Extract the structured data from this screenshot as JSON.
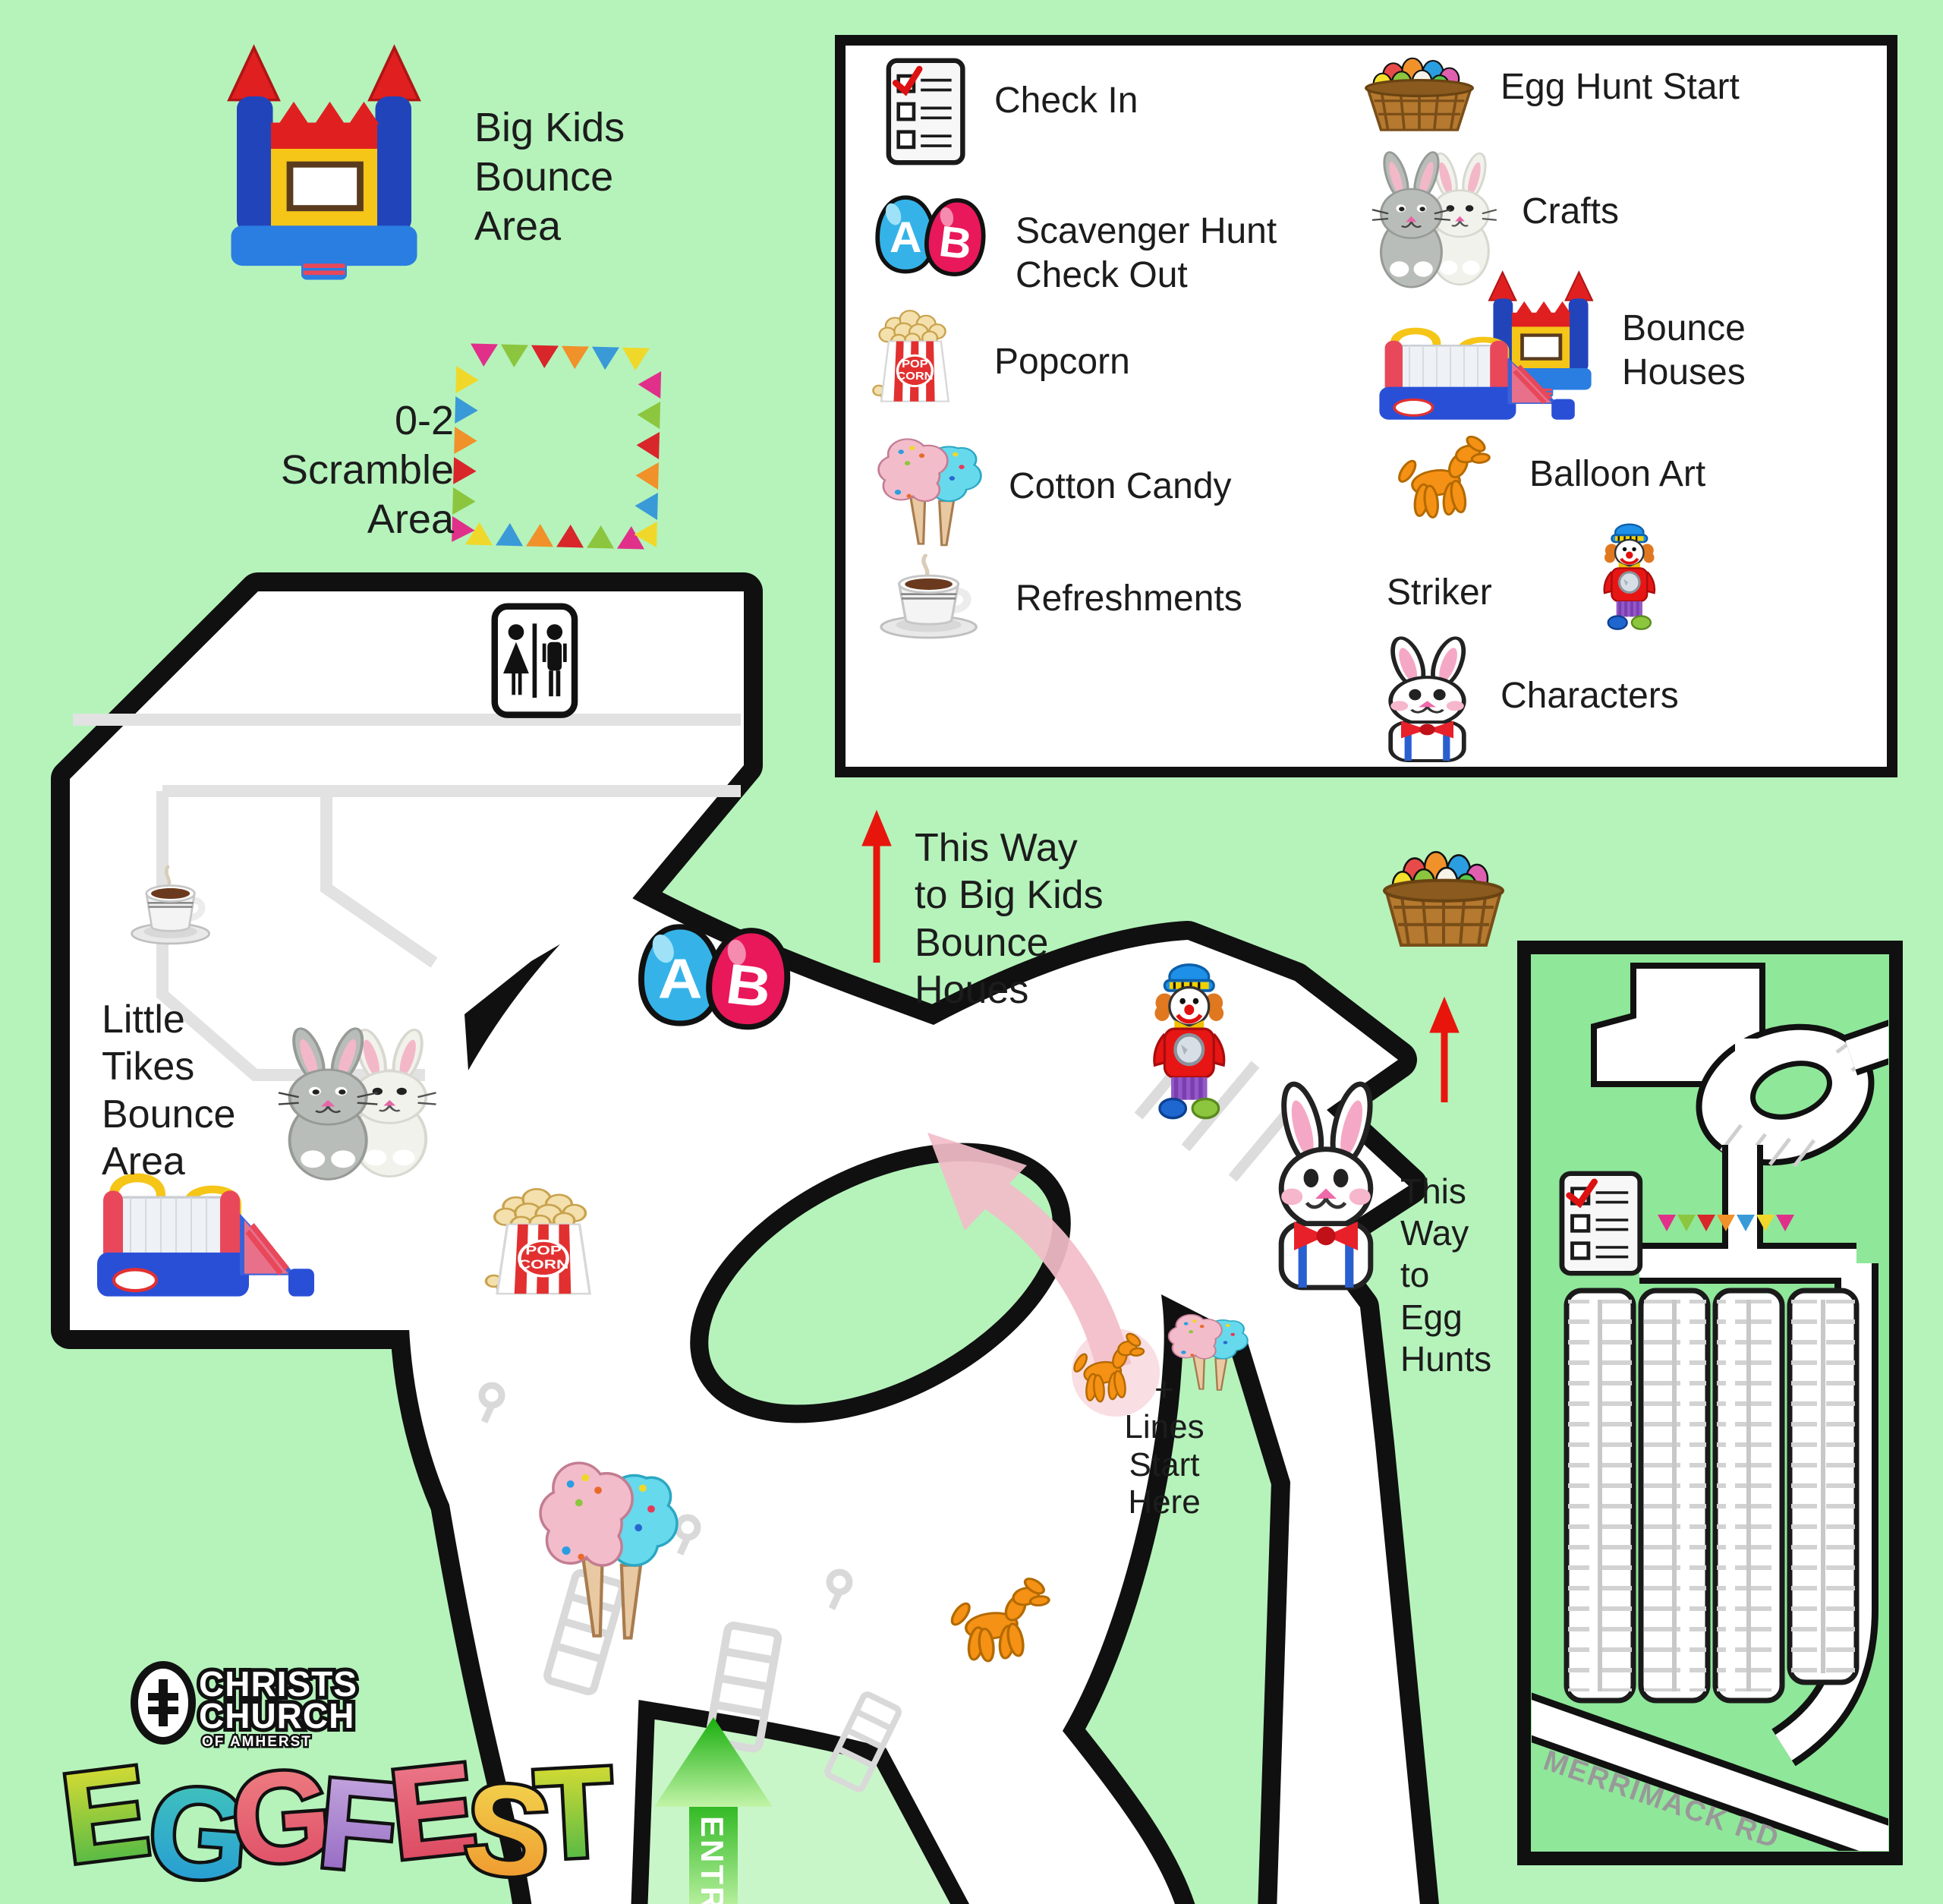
{
  "colors": {
    "bg": "#b5f3bb",
    "inset_bg": "#8fe79a",
    "entry_bg": "#c9f6c9",
    "outline": "#101010",
    "gray_line": "#e2e2e2",
    "red": "#e8150d",
    "pink": "#f2bdc9",
    "text": "#1c1c1c"
  },
  "legend": {
    "left": [
      {
        "icon": "checklist-icon",
        "label": "Check In"
      },
      {
        "icon": "ab-eggs-icon",
        "label": "Scavenger Hunt\nCheck Out"
      },
      {
        "icon": "popcorn-icon",
        "label": "Popcorn"
      },
      {
        "icon": "cotton-candy-icon",
        "label": "Cotton Candy"
      },
      {
        "icon": "coffee-icon",
        "label": "Refreshments"
      }
    ],
    "right": [
      {
        "icon": "egg-basket-icon",
        "label": "Egg Hunt Start"
      },
      {
        "icon": "bunny-crafts-icon",
        "label": "Crafts"
      },
      {
        "icon": "bounce-houses-icon",
        "label": "Bounce\nHouses"
      },
      {
        "icon": "balloon-dog-icon",
        "label": "Balloon Art"
      },
      {
        "icon": "clown-icon",
        "label": "Striker"
      },
      {
        "icon": "bunny-character-icon",
        "label": "Characters"
      }
    ]
  },
  "map_labels": {
    "big_kids": "Big Kids\nBounce\nArea",
    "scramble": "0-2\nScramble\nArea",
    "little_tikes": "Little\nTikes\nBounce\nArea",
    "this_way_bounce": "This Way\nto Big Kids\nBounce\nHoues",
    "this_way_egg": "This\nWay\nto\nEgg\nHunts",
    "lines_start": "+\nLines\nStart\nHere",
    "entry": "ENTRY",
    "road": "MERRIMACK RD"
  },
  "icons": {
    "egg_a": "A",
    "egg_b": "B",
    "popcorn_top": "POP",
    "popcorn_bottom": "CORN"
  },
  "logo": {
    "church_line1": "CHRISTS",
    "church_line2": "CHURCH",
    "church_line3": "OF AMHERST",
    "title_letters": [
      {
        "ch": "E"
      },
      {
        "ch": "G"
      },
      {
        "ch": "G"
      },
      {
        "ch": "F"
      },
      {
        "ch": "E"
      },
      {
        "ch": "S"
      },
      {
        "ch": "T"
      }
    ]
  }
}
